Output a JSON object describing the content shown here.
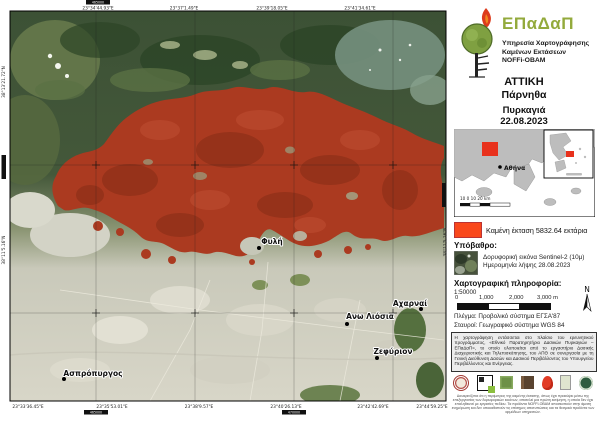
{
  "map": {
    "places": [
      {
        "name": "Φυλή"
      },
      {
        "name": "Αχαρναί"
      },
      {
        "name": "Ανω Λιόσια"
      },
      {
        "name": "Ζεφύριον"
      },
      {
        "name": "Ασπρόπυργος"
      }
    ],
    "coords_top": [
      "23°34'44.93\"E",
      "23°37'1.49\"E",
      "23°39'18.05\"E",
      "23°41'34.61\"E"
    ],
    "coords_bottom": [
      "23°33'36.45\"E",
      "23°35'53.01\"E",
      "23°38'9.57\"E",
      "23°40'26.13\"E",
      "23°42'42.69\"E",
      "23°44'59.25\"E"
    ],
    "coords_left": [
      "38°13'21.72\"N",
      "38°11'5.16\"N"
    ],
    "coords_right": [
      "38°11'5.16\"N"
    ],
    "grid_labels": {
      "top": "465000",
      "bottom_left": "465000",
      "bottom_right": "470000",
      "left": "4215000"
    },
    "burned_color": "#ab3a20"
  },
  "panel": {
    "logo": {
      "acronym": "ΕΠαΔαΠ",
      "line1": "Υπηρεσία Χαρτογράφησης",
      "line2": "Καμένων Εκτάσεων",
      "line3": "NOFFi-OBAM",
      "icon": "tree-flame-icon"
    },
    "title": {
      "region": "ΑΤΤΙΚΗ",
      "area": "Πάρνηθα",
      "event": "Πυρκαγιά",
      "date": "22.08.2023"
    },
    "inset": {
      "city": "Αθήνα",
      "scale": "10  0  10  20 km"
    },
    "legend": {
      "label": "Καμένη έκταση 5832.64 εκτάρια",
      "color": "#f9481b"
    },
    "basemap": {
      "heading": "Υπόβαθρο:",
      "line1": "Δορυφορική εικόνα Sentinel-2 (10μ)",
      "line2": "Ημερομηνία λήψης 28.08.2023"
    },
    "carto": {
      "heading": "Χαρτογραφική πληροφορία:",
      "scale": "1:50000",
      "tick0": "0",
      "tick1": "1,000",
      "tick2": "2,000",
      "tick3": "3,000 m",
      "north": "N"
    },
    "notes": {
      "grid": "Πλέγμα: Προβολικό σύστημα ΕΓΣΑ'87",
      "crosses": "Σταυροί: Γεωγραφικό σύστημα WGS 84"
    },
    "credits": "Η χαρτογράφηση εντάσσεται στο πλαίσιο του ερευνητικού προγράμματος, «Εθνικό Παρατηρητήριο Δασικών Πυρκαγιών – ΕΠαΔαΠ», το οποίο υλοποιείται από το εργαστήριο Δασικής Διαχειριστικής και Τηλεπισκόπησης, του ΑΠΘ σε συνεργασία με τη Γενική Διεύθυνση Δασών και Δασικού Περιβάλλοντος του Υπουργείου Περιβάλλοντος και Ενέργειας.",
    "disclaimer": "Διευκρινίζεται ότι η περίμετρος της καμένης έκτασης, όπως έχει προκύψει μέσω της επεξεργασίας των δορυφορικών εικόνων, αποτελεί μια πρώτη εκτίμηση, η οποία δεν έχει επαληθευτεί με εργασίες πεδίου. Τα προϊόντα NOFFi-OBAM αποσκοπούν στην άμεση ενημέρωση και δεν υποκαθιστούν τις επίσημες αποτυπώσεις και τα θεσμικά προϊόντα των αρμόδιων υπηρεσιών.",
    "logo_icons": [
      "university-seal-icon",
      "lab-logo-icon",
      "forest-service-icon",
      "wood-research-icon",
      "fire-service-icon",
      "program-logo-icon",
      "ministry-environment-icon"
    ]
  }
}
